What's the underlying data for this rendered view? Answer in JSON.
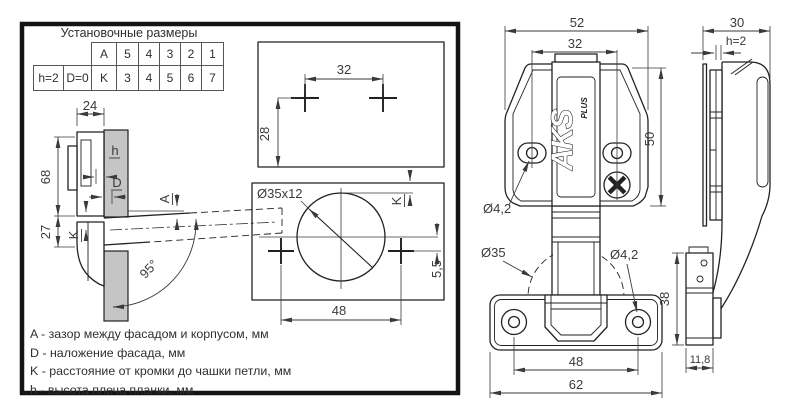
{
  "table": {
    "title": "Установочные размеры",
    "row1": [
      "A",
      "5",
      "4",
      "3",
      "2",
      "1"
    ],
    "row2": [
      "h=2",
      "D=0",
      "K",
      "3",
      "4",
      "5",
      "6",
      "7"
    ]
  },
  "legend": [
    "A - зазор между фасадом и корпусом, мм",
    "D - наложение фасада, мм",
    "K - расстояние от кромки до чашки петли, мм",
    "h - высота плеча планки, мм"
  ],
  "section_view": {
    "dim_depth": "24",
    "dim_height_upper": "68",
    "dim_height_lower": "27",
    "label_h": "h",
    "label_d": "D",
    "label_a": "A",
    "label_k": "K",
    "opening_angle": "95°"
  },
  "plate_drilling": {
    "dim_hole_spacing": "32",
    "dim_edge_offset": "28"
  },
  "cup_drilling": {
    "cup_size": "Ø35x12",
    "label_k": "K",
    "dim_center_offset": "5,5",
    "dim_hole_spacing": "48"
  },
  "hinge_front": {
    "dim_width": "52",
    "dim_hole_spacing": "32",
    "dim_height": "50",
    "hole_dia": "Ø4,2",
    "logo": "AKS",
    "logo_sub": "PLUS"
  },
  "hinge_cup": {
    "cup_dia": "Ø35",
    "hole_dia": "Ø4,2",
    "dim_depth": "38",
    "dim_hole_spacing": "48",
    "dim_width": "62"
  },
  "hinge_side": {
    "dim_depth": "30",
    "dim_plate_height": "h=2",
    "dim_cup_side": "11,8"
  },
  "colors": {
    "line": "#222222",
    "dim": "#3a3a3a",
    "panel_fill": "#c5c5c5",
    "frame": "#141414",
    "background": "#ffffff"
  }
}
